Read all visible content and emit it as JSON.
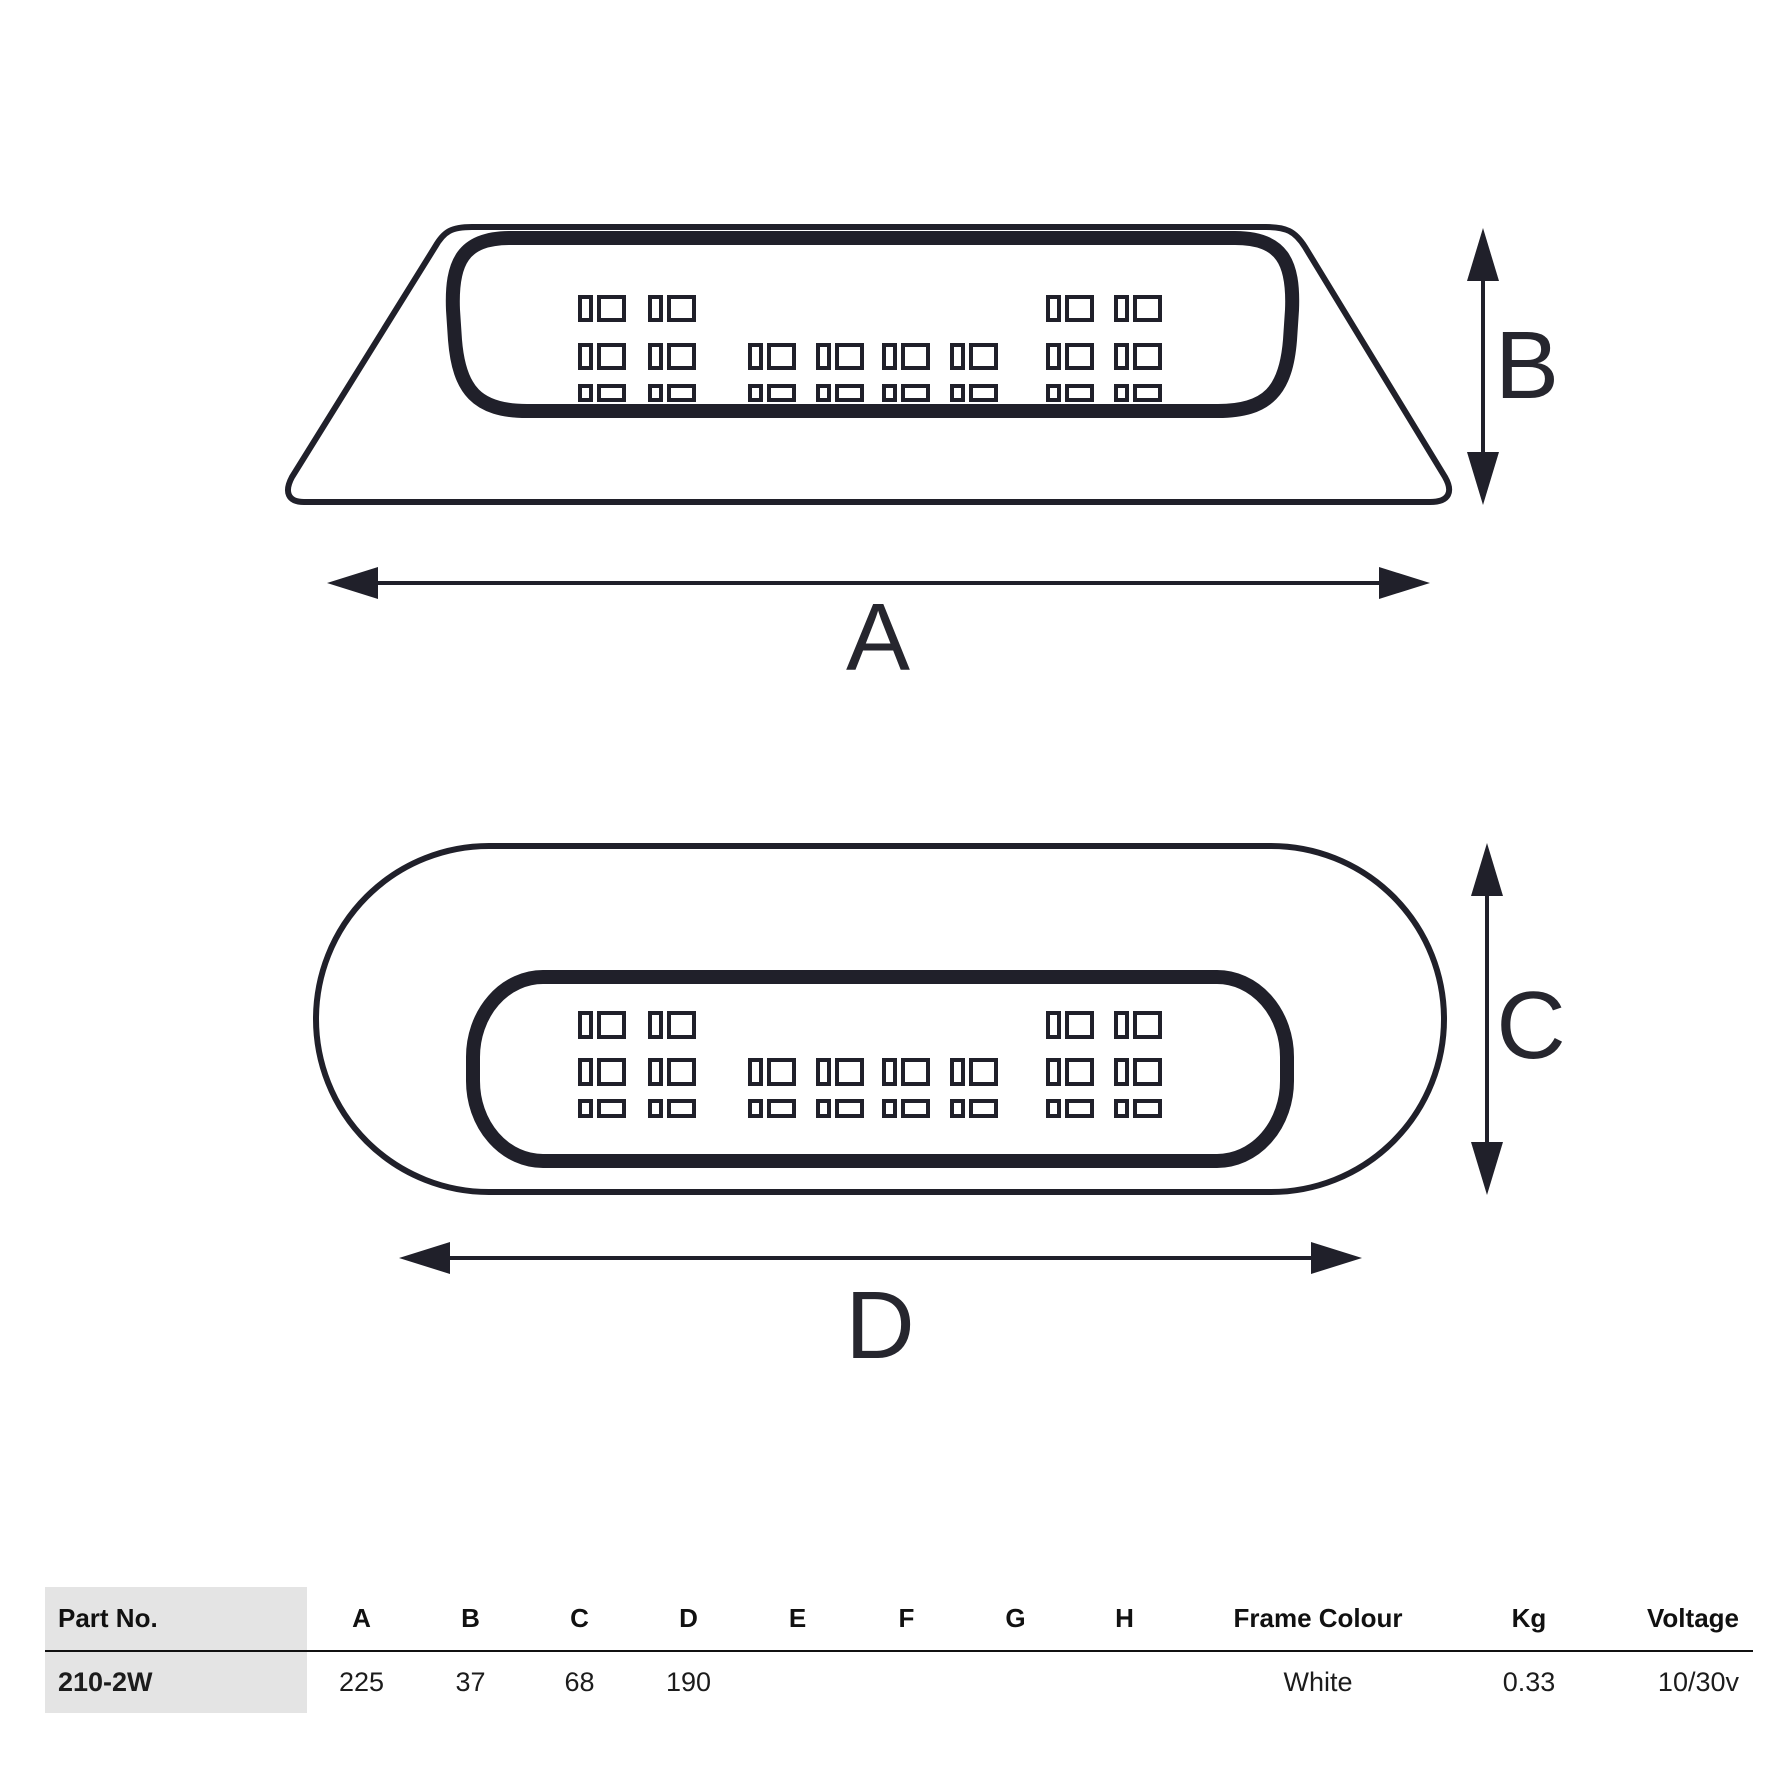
{
  "diagram": {
    "dim_labels": {
      "a": "A",
      "b": "B",
      "c": "C",
      "d": "D"
    }
  },
  "table": {
    "headers": [
      "Part No.",
      "A",
      "B",
      "C",
      "D",
      "E",
      "F",
      "G",
      "H",
      "Frame Colour",
      "Kg",
      "Voltage"
    ],
    "rows": [
      {
        "part_no": "210-2W",
        "a": "225",
        "b": "37",
        "c": "68",
        "d": "190",
        "e": "",
        "f": "",
        "g": "",
        "h": "",
        "frame_colour": "White",
        "kg": "0.33",
        "voltage": "10/30v"
      }
    ]
  },
  "colors": {
    "ink": "#20202a",
    "table_header_bg": "#e4e4e4",
    "divider": "#111111",
    "background": "#ffffff"
  },
  "led_pattern": {
    "narrow_w": 11,
    "wide_w": 25,
    "pair_gap": 8,
    "groups": {
      "left": [
        580,
        650
      ],
      "middle": [
        750,
        818,
        884,
        952
      ],
      "right": [
        1048,
        1116
      ]
    },
    "rows": [
      {
        "groups": [
          "left",
          "right"
        ]
      },
      {
        "groups": [
          "left",
          "middle",
          "right"
        ]
      },
      {
        "groups": [
          "left",
          "middle",
          "right"
        ]
      }
    ],
    "diagrams": [
      {
        "group": "led-group-1",
        "rows_y": [
          297,
          345,
          386
        ],
        "rows_h": [
          23,
          23,
          14
        ]
      },
      {
        "group": "led-group-2",
        "rows_y": [
          1013,
          1060,
          1101
        ],
        "rows_h": [
          24,
          24,
          15
        ]
      }
    ]
  }
}
